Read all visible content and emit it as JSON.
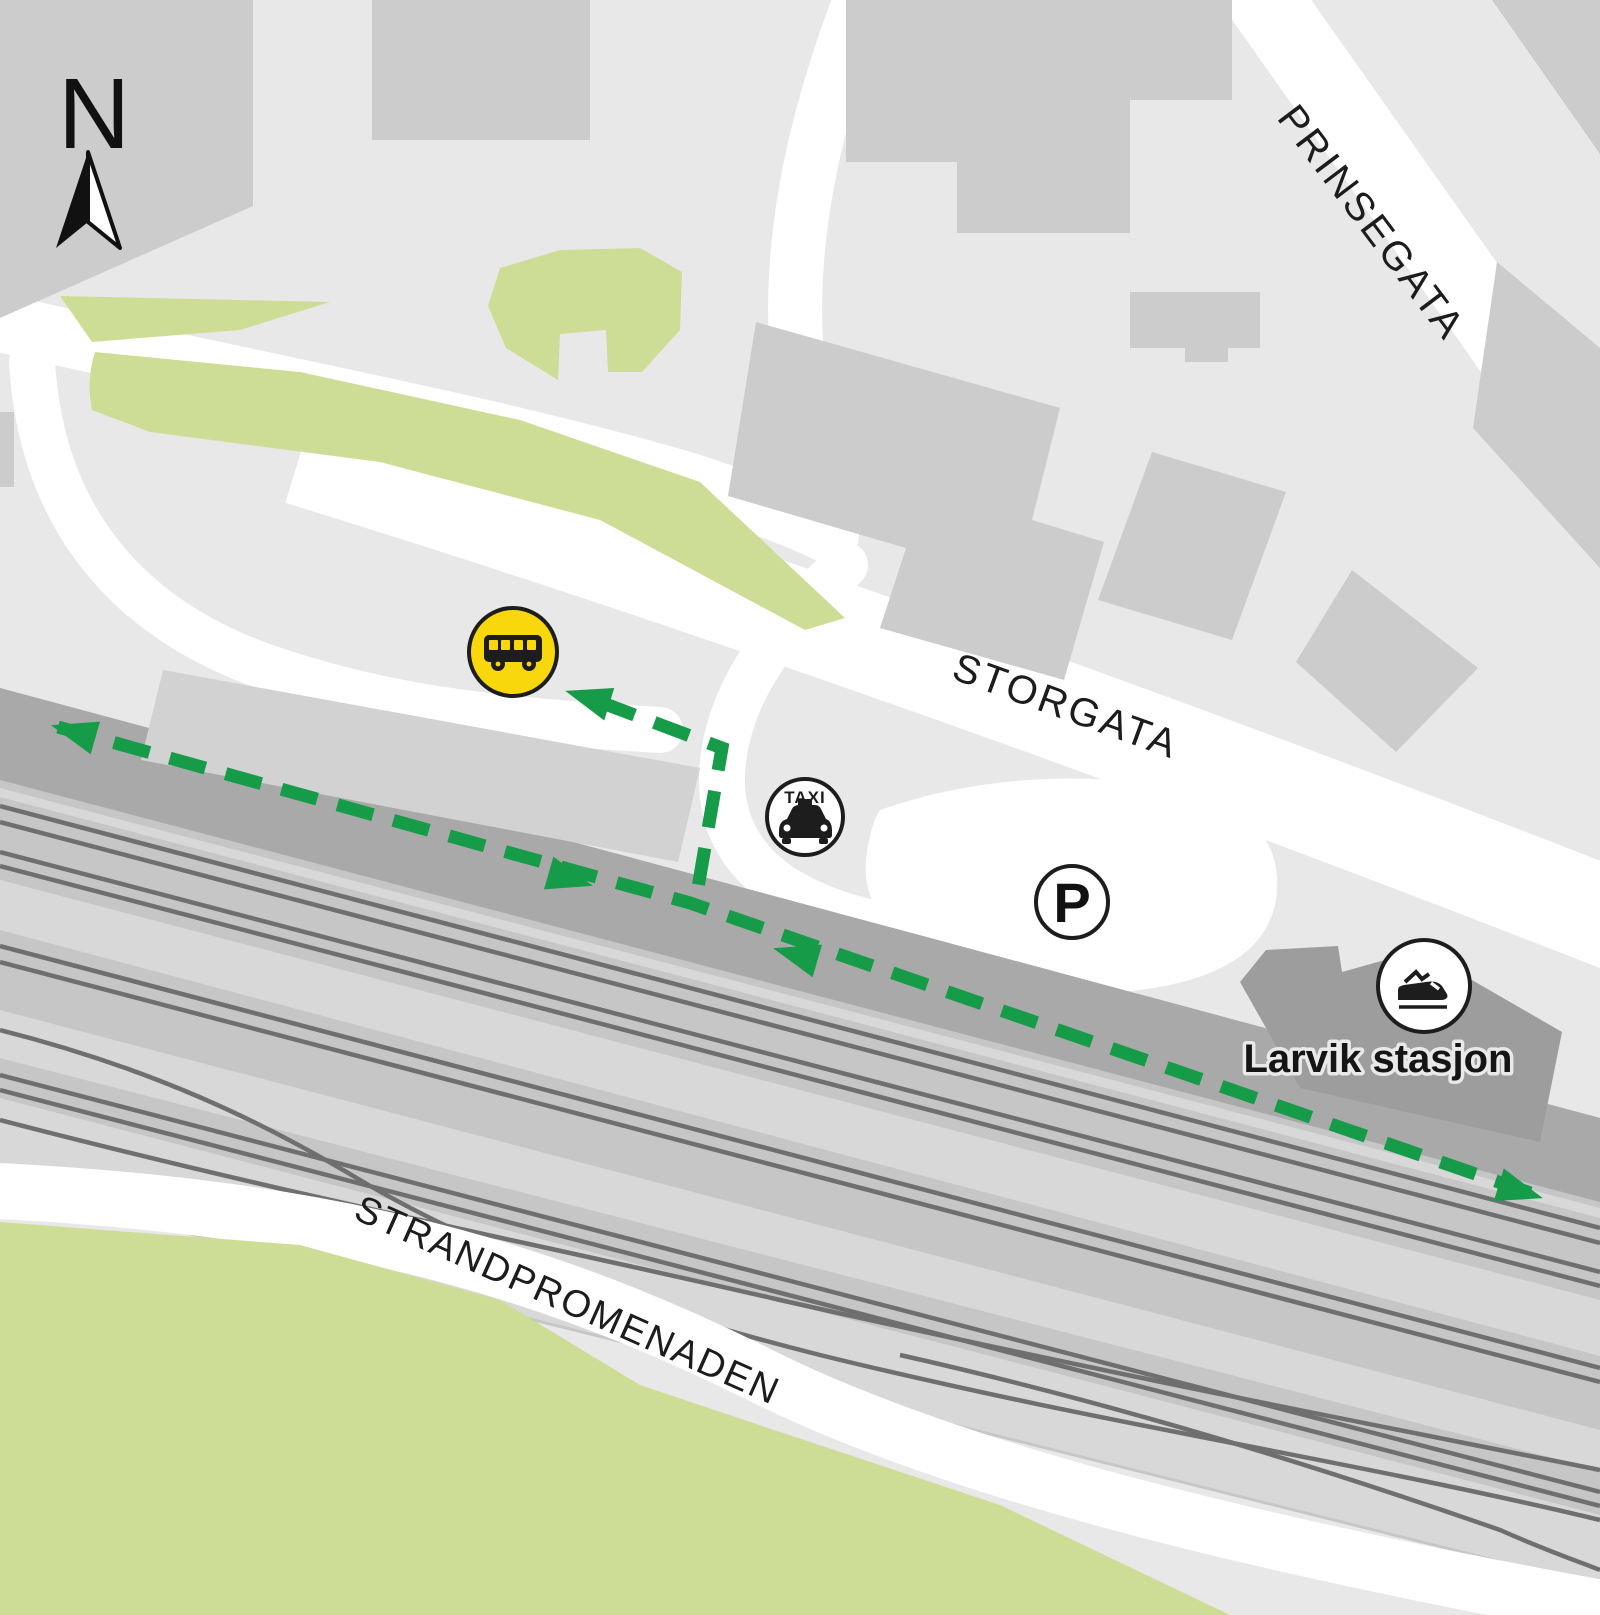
{
  "compass": {
    "label": "N"
  },
  "streets": {
    "prinsegata": "PRINSEGATA",
    "storgata": "STORGATA",
    "strandpromenaden": "STRANDPROMENADEN"
  },
  "station": {
    "label": "Larvik stasjon"
  },
  "icons": {
    "bus_stop": "bus-stop-icon",
    "taxi": "taxi-icon",
    "taxi_label": "TAXI",
    "parking": "parking-icon",
    "parking_label": "P",
    "train": "train-station-icon",
    "compass": "north-arrow-icon"
  },
  "colors": {
    "background": "#e8e8e8",
    "building": "#cccccc",
    "station_building": "#9d9d9d",
    "road": "#ffffff",
    "park_green": "#cedd96",
    "railway_platform": "#a9a9a9",
    "railway_bed": "#c6c6c6",
    "railway_light_strip": "#d8d8d8",
    "track_line": "#6f6f6f",
    "route_green": "#169b49",
    "bus_yellow": "#f9d70d",
    "icon_outline": "#1d1d1d",
    "label_text": "#1c1c1c"
  }
}
